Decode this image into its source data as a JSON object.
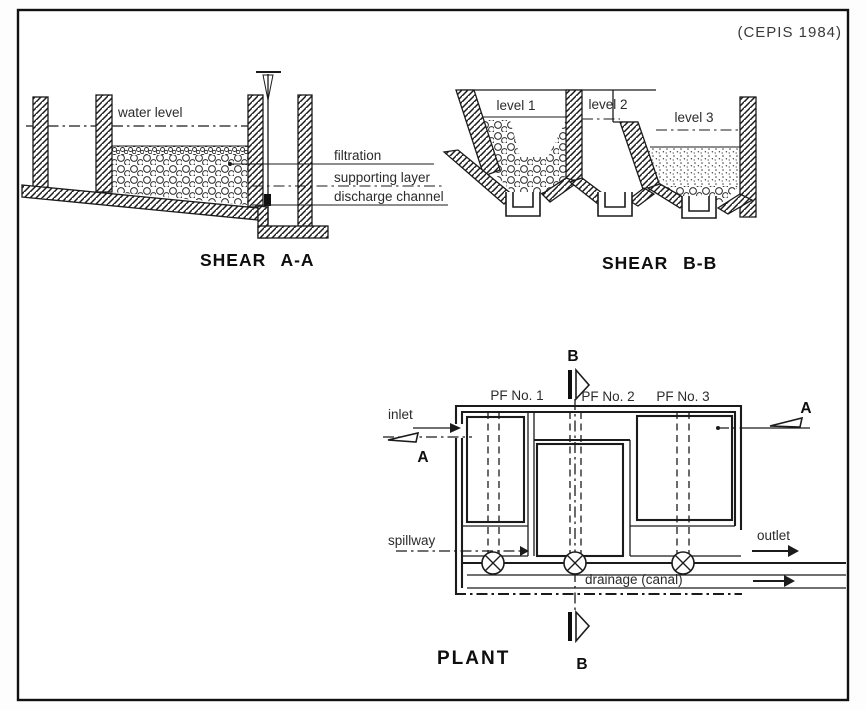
{
  "citation": "(CEPIS 1984)",
  "shear_aa": {
    "title": "SHEAR A-A",
    "water_level_label": "water level",
    "filtration_label": "filtration",
    "supporting_layer_label": "supporting layer",
    "discharge_channel_label": "discharge channel"
  },
  "shear_bb": {
    "title": "SHEAR B-B",
    "level1_label": "level 1",
    "level2_label": "level 2",
    "level3_label": "level 3"
  },
  "plant": {
    "title": "PLANT",
    "pf1_label": "PF No. 1",
    "pf2_label": "PF No. 2",
    "pf3_label": "PF No. 3",
    "inlet_label": "inlet",
    "outlet_label": "outlet",
    "spillway_label": "spillway",
    "drainage_label": "drainage (canal)",
    "section_a_label": "A",
    "section_b_label": "B"
  }
}
